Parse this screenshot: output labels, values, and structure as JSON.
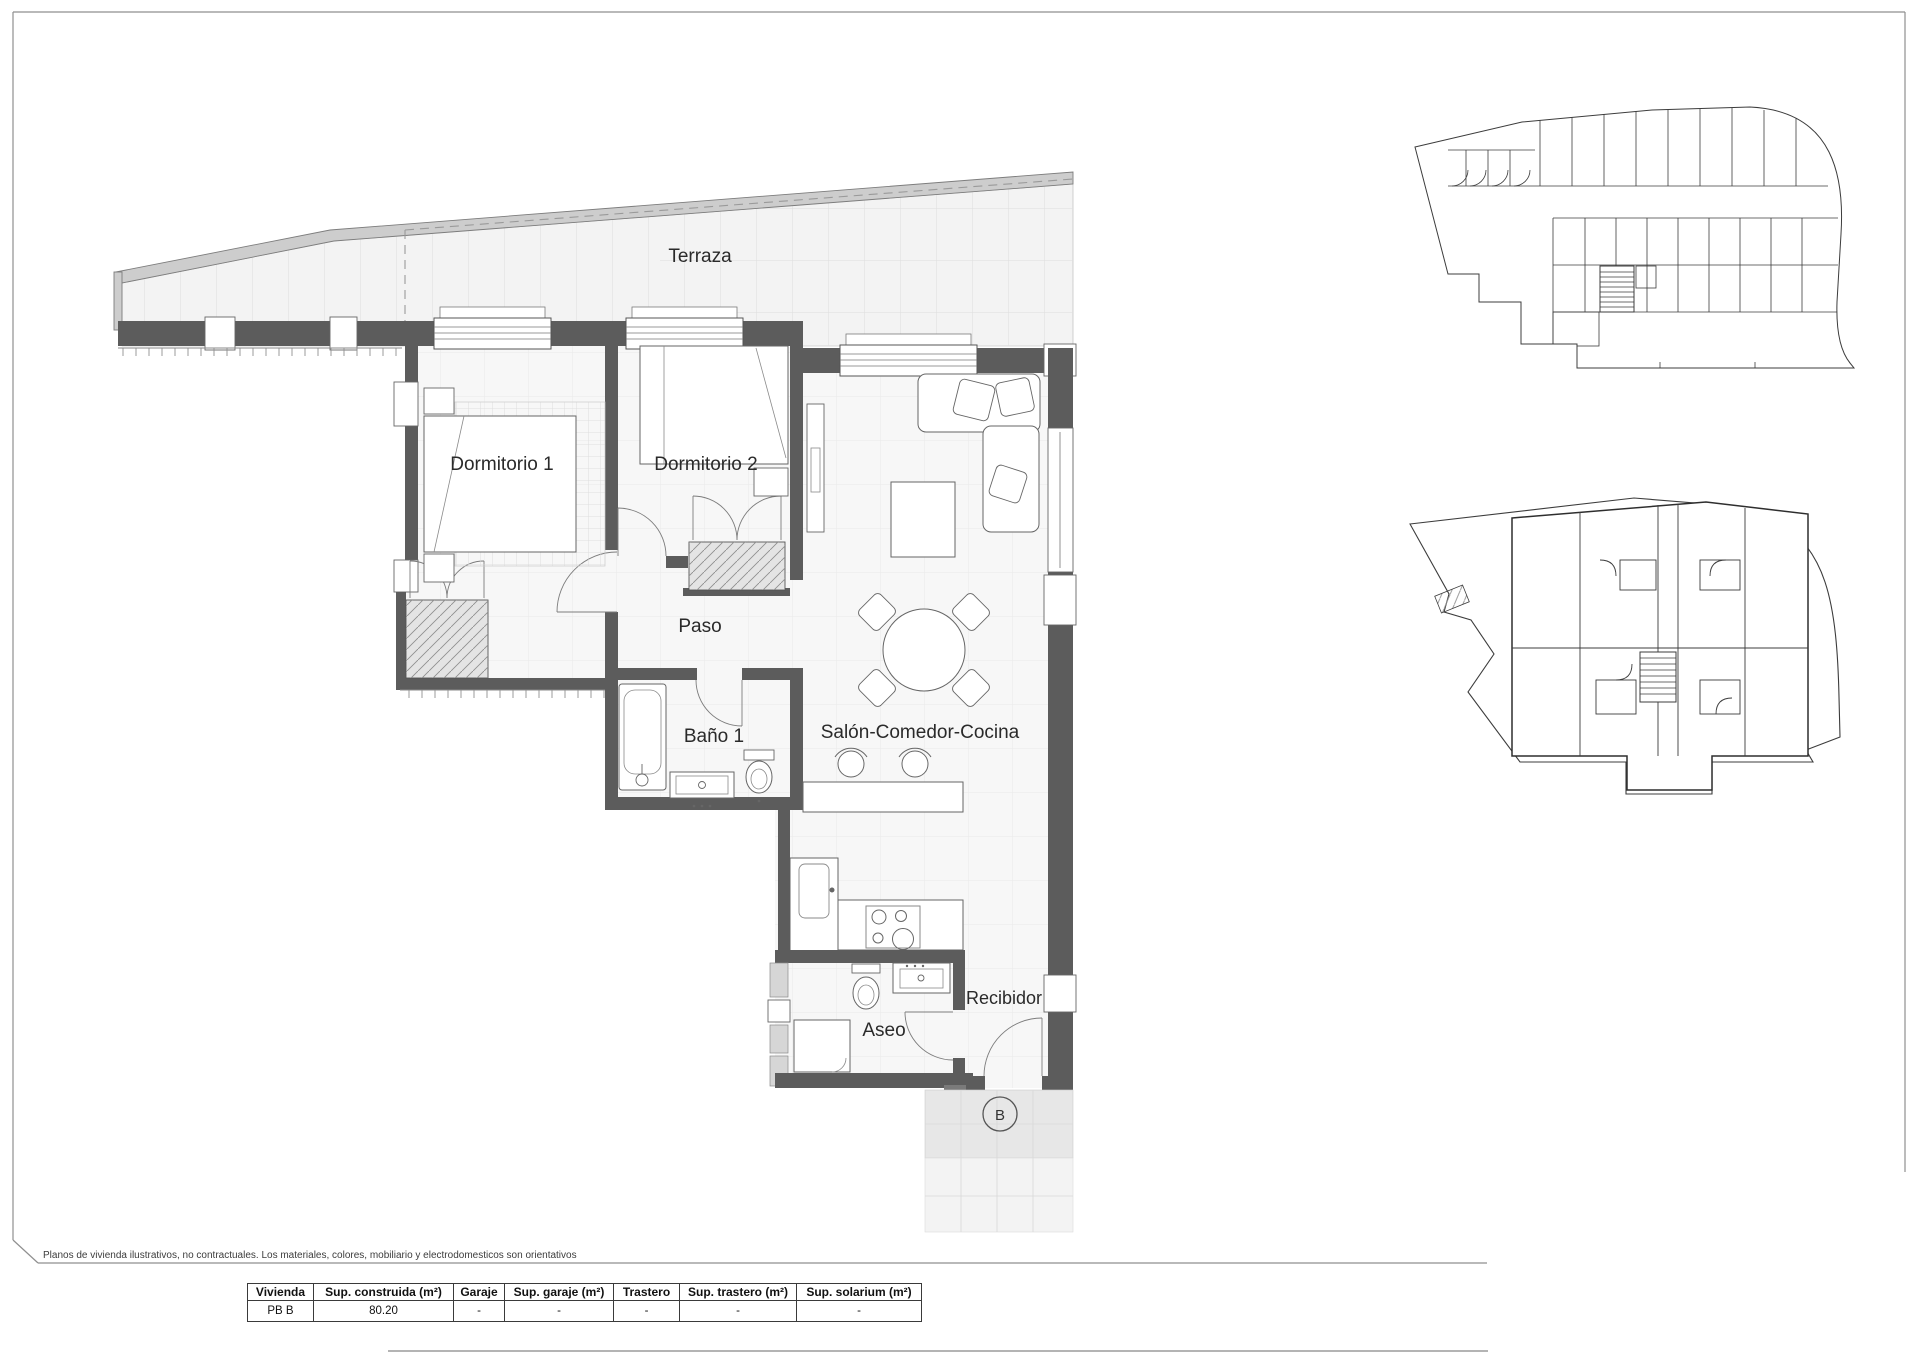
{
  "page": {
    "disclaimer": "Planos de vivienda ilustrativos, no contractuales. Los materiales, colores, mobiliario y electrodomesticos son orientativos"
  },
  "plan": {
    "rooms": [
      {
        "id": "terraza",
        "label": "Terraza"
      },
      {
        "id": "dormitorio-1",
        "label": "Dormitorio 1"
      },
      {
        "id": "dormitorio-2",
        "label": "Dormitorio 2"
      },
      {
        "id": "paso",
        "label": "Paso"
      },
      {
        "id": "bano-1",
        "label": "Baño 1"
      },
      {
        "id": "salon-comedor-cocina",
        "label": "Salón-Comedor-Cocina"
      },
      {
        "id": "aseo",
        "label": "Aseo"
      },
      {
        "id": "recibidor",
        "label": "Recibidor"
      }
    ],
    "unit_marker": "B",
    "colors": {
      "wall": "#5c5c5c",
      "floor": "#f6f6f6",
      "line": "#3c3c3c"
    }
  },
  "table": {
    "headers": [
      "Vivienda",
      "Sup. construida (m²)",
      "Garaje",
      "Sup. garaje (m²)",
      "Trastero",
      "Sup. trastero (m²)",
      "Sup. solarium (m²)"
    ],
    "rows": [
      [
        "PB B",
        "80.20",
        "-",
        "-",
        "-",
        "-",
        "-"
      ]
    ]
  }
}
